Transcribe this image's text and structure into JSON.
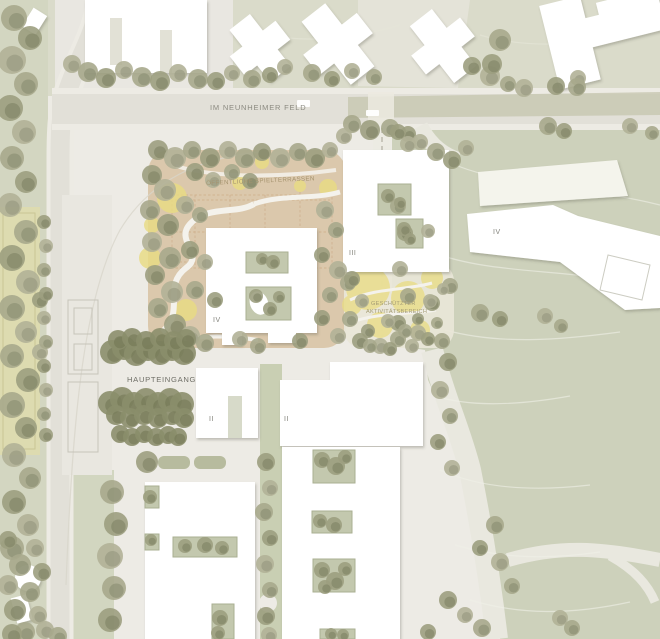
{
  "plan": {
    "street": {
      "name_label": "IM NEUNHEIMER FELD"
    },
    "area_labels": {
      "play_terraces": "ÖFFENTLICHE SPIELTERRASSEN",
      "protected_activity_line1": "GESCHÜTZTER",
      "protected_activity_line2": "AKTIVITÄTSBEREICH",
      "main_entrance": "HAUPTEINGANG"
    },
    "building_storeys": {
      "block_north": "III",
      "block_center": "IV",
      "block_east": "IV",
      "wing_left": "II",
      "wing_right": "II"
    },
    "colors": {
      "background": "#edebe5",
      "lawn": "#cdd1bb",
      "lawn-dark": "#c2c7ac",
      "tree": "#a2a487",
      "road": "#e2e0d8",
      "road-band": "#c7c7b0",
      "building": "#ffffff",
      "terrace": "#dbc8ac",
      "accent-yellow": "#e9dc82",
      "label": "#85857c"
    }
  }
}
